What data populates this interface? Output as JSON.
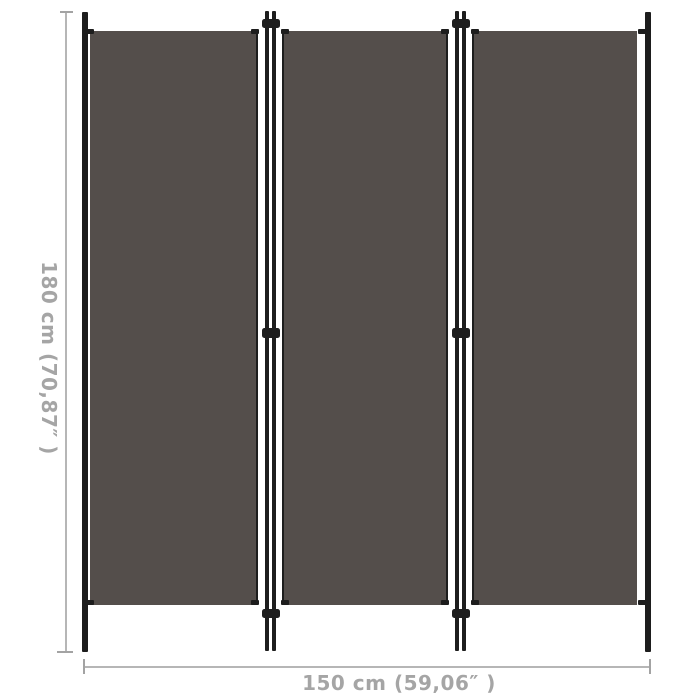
{
  "image": {
    "type": "product-dimension-diagram",
    "subject": "3-panel room divider, anthracite fabric with black frame",
    "background": "#ffffff"
  },
  "divider": {
    "panel_count": 3,
    "junction_count": 2,
    "hinges_per_junction": 3
  },
  "annotations": {
    "height_label": "180 cm (70,87″ )",
    "width_label": "150 cm (59,06″ )"
  },
  "colors": {
    "fabric": "#544e4b",
    "frame": "#1d1d1d",
    "dim_line": "#b6b6b6",
    "dim_cap": "#a3a3a3",
    "dim_text": "#a5a5a5",
    "background": "#ffffff"
  }
}
